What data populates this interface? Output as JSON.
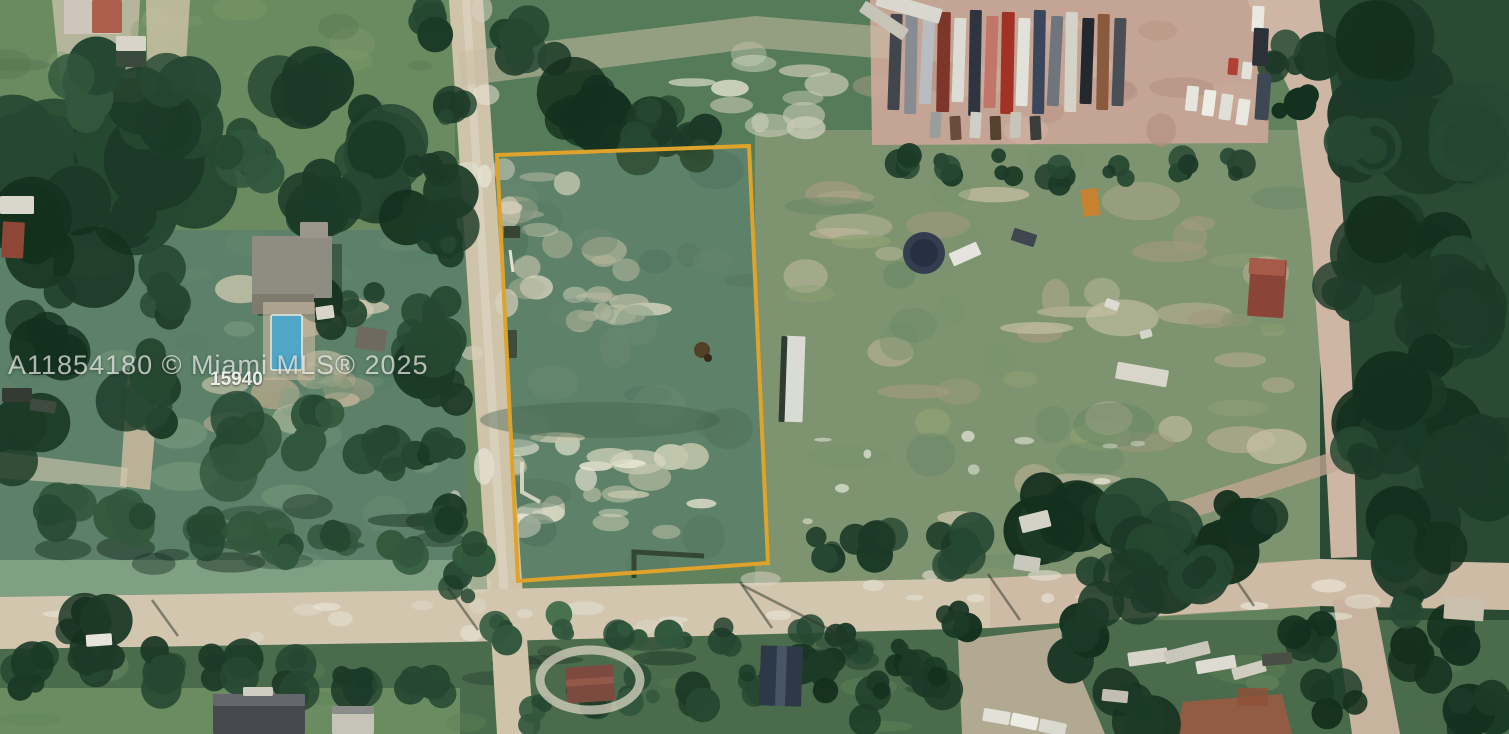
{
  "watermark": {
    "listing_line": "A11854180 © Miami MLS® 2025",
    "lot_number": "15940"
  },
  "colors": {
    "parcel_outline": "#DFA32B",
    "pool_water": "#4FA6C6",
    "dirt_road": "#CFC3AA",
    "truck_yard_dirt": "#C4A595",
    "field_green": "#61825C",
    "tree_dark_green": "#1C3A27",
    "watermark_text": "rgba(255,255,255,0.66)",
    "lot_number_text": "rgba(255,255,255,0.88)"
  }
}
